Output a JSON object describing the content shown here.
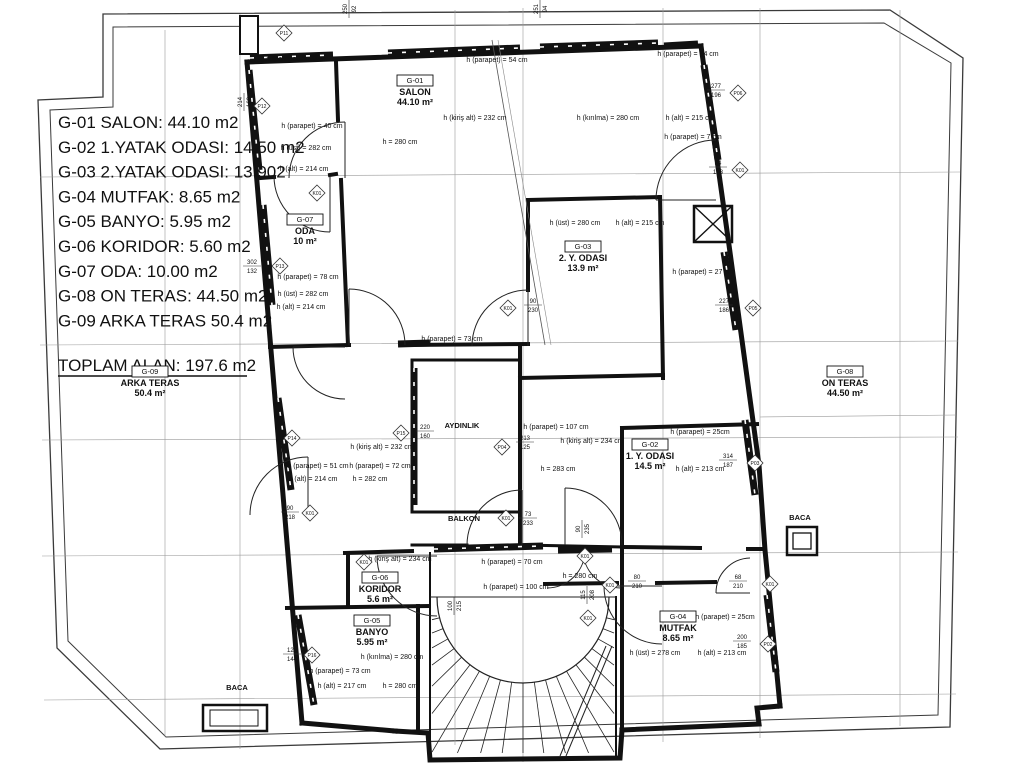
{
  "colors": {
    "line": "#1a1a1a",
    "bg": "#ffffff",
    "grid": "#8a8a8a"
  },
  "legend": {
    "items": [
      "G-01 SALON: 44.10 m2",
      "G-02  1.YATAK ODASI: 14.50 m2",
      "G-03  2.YATAK ODASI: 13.902",
      "G-04  MUTFAK: 8.65 m2",
      "G-05 BANYO: 5.95 m2",
      "G-06 KORIDOR: 5.60 m2",
      "G-07 ODA: 10.00 m2",
      "G-08 ON TERAS: 44.50 m2",
      "G-09 ARKA TERAS 50.4 m2"
    ],
    "total": "TOPLAM ALAN: 197.6 m2"
  },
  "rooms": [
    {
      "code": "G-01",
      "name": "SALON",
      "area": "44.10  m²",
      "x": 415,
      "y": 83
    },
    {
      "code": "G-03",
      "name": "2. Y. ODASI",
      "area": "13.9 m²",
      "x": 583,
      "y": 249
    },
    {
      "code": "G-07",
      "name": "ODA",
      "area": "10 m²",
      "x": 305,
      "y": 222
    },
    {
      "code": "G-02",
      "name": "1. Y. ODASI",
      "area": "14.5 m²",
      "x": 650,
      "y": 447
    },
    {
      "code": "G-06",
      "name": "KORIDOR",
      "area": "5.6 m²",
      "x": 380,
      "y": 580
    },
    {
      "code": "G-05",
      "name": "BANYO",
      "area": "5.95 m²",
      "x": 372,
      "y": 623
    },
    {
      "code": "G-04",
      "name": "MUTFAK",
      "area": "8.65 m²",
      "x": 678,
      "y": 619
    },
    {
      "code": "G-08",
      "name": "ON TERAS",
      "area": "44.50 m²",
      "x": 845,
      "y": 374
    },
    {
      "code": "G-09",
      "name": "ARKA TERAS",
      "area": "50.4 m²",
      "x": 150,
      "y": 374
    },
    {
      "code": null,
      "name": "AYDINLIK",
      "area": "",
      "x": 462,
      "y": 428
    },
    {
      "code": null,
      "name": "BALKON",
      "area": "",
      "x": 464,
      "y": 521
    },
    {
      "code": null,
      "name": "BACA",
      "area": "",
      "x": 237,
      "y": 690
    },
    {
      "code": null,
      "name": "BACA",
      "area": "",
      "x": 800,
      "y": 520
    }
  ],
  "annotations": [
    {
      "text": "h (parapet) = 40 cm",
      "x": 297,
      "y": 61
    },
    {
      "text": "h (parapet) = 54 cm",
      "x": 497,
      "y": 62
    },
    {
      "text": "h (parapet) = 54 cm",
      "x": 688,
      "y": 56
    },
    {
      "text": "h (parapet) = 40 cm",
      "x": 312,
      "y": 128
    },
    {
      "text": "h (üst) = 282 cm",
      "x": 306,
      "y": 150
    },
    {
      "text": "h (alt) = 214 cm",
      "x": 304,
      "y": 171
    },
    {
      "text": "h (kiriş alt) = 232 cm",
      "x": 475,
      "y": 120
    },
    {
      "text": "h = 280 cm",
      "x": 400,
      "y": 144
    },
    {
      "text": "h (kırılma) = 280 cm",
      "x": 608,
      "y": 120
    },
    {
      "text": "h (alt) = 215 cm",
      "x": 690,
      "y": 120
    },
    {
      "text": "h (parapet) = 7 cm",
      "x": 693,
      "y": 139
    },
    {
      "text": "h (üst) = 280 cm",
      "x": 575,
      "y": 225
    },
    {
      "text": "h (alt) = 215 cm",
      "x": 640,
      "y": 225
    },
    {
      "text": "h (parapet) = 27 cm",
      "x": 703,
      "y": 274
    },
    {
      "text": "h (parapet) = 78 cm",
      "x": 308,
      "y": 279
    },
    {
      "text": "h (üst) = 282 cm",
      "x": 303,
      "y": 296
    },
    {
      "text": "h (alt) = 214 cm",
      "x": 301,
      "y": 309
    },
    {
      "text": "h (parapet) = 73 cm",
      "x": 452,
      "y": 341
    },
    {
      "text": "h (parapet) = 51 cm",
      "x": 318,
      "y": 468
    },
    {
      "text": "h (alt) = 214 cm",
      "x": 313,
      "y": 481
    },
    {
      "text": "h (kiriş alt) = 232 cm",
      "x": 382,
      "y": 449
    },
    {
      "text": "h (parapet) = 72 cm",
      "x": 380,
      "y": 468
    },
    {
      "text": "h = 282 cm",
      "x": 370,
      "y": 481
    },
    {
      "text": "h (parapet) = 107 cm",
      "x": 556,
      "y": 429
    },
    {
      "text": "h (kiriş alt) = 234 cm",
      "x": 592,
      "y": 443
    },
    {
      "text": "h = 283 cm",
      "x": 558,
      "y": 471
    },
    {
      "text": "h (parapet) = 25cm",
      "x": 700,
      "y": 434
    },
    {
      "text": "h (alt) = 213 cm",
      "x": 700,
      "y": 471
    },
    {
      "text": "h (kiriş alt) = 234 cm",
      "x": 400,
      "y": 561
    },
    {
      "text": "h (parapet) = 70 cm",
      "x": 512,
      "y": 564
    },
    {
      "text": "h (parapet) = 100 cm",
      "x": 516,
      "y": 589
    },
    {
      "text": "h = 280 cm",
      "x": 580,
      "y": 578
    },
    {
      "text": "h (kırılma) = 280 cm",
      "x": 392,
      "y": 659
    },
    {
      "text": "h (parapet) = 73 cm",
      "x": 340,
      "y": 673
    },
    {
      "text": "h (alt) = 217 cm",
      "x": 342,
      "y": 688
    },
    {
      "text": "h = 280 cm",
      "x": 400,
      "y": 688
    },
    {
      "text": "h (üst) = 278 cm",
      "x": 655,
      "y": 655
    },
    {
      "text": "h (alt) = 213 cm",
      "x": 722,
      "y": 655
    },
    {
      "text": "h (parapet) = 25cm",
      "x": 725,
      "y": 619
    }
  ],
  "markers": [
    {
      "label": "P11",
      "x": 284,
      "y": 33
    },
    {
      "label": "P12",
      "x": 262,
      "y": 106
    },
    {
      "label": "P13",
      "x": 280,
      "y": 266
    },
    {
      "label": "P14",
      "x": 292,
      "y": 438
    },
    {
      "label": "P15",
      "x": 401,
      "y": 433
    },
    {
      "label": "P16",
      "x": 312,
      "y": 655
    },
    {
      "label": "P06",
      "x": 738,
      "y": 93
    },
    {
      "label": "P05",
      "x": 753,
      "y": 308
    },
    {
      "label": "P04",
      "x": 502,
      "y": 447
    },
    {
      "label": "P03",
      "x": 755,
      "y": 463
    },
    {
      "label": "P02",
      "x": 768,
      "y": 644
    },
    {
      "label": "K01",
      "x": 317,
      "y": 193
    },
    {
      "label": "K01",
      "x": 508,
      "y": 308
    },
    {
      "label": "K01",
      "x": 740,
      "y": 170
    },
    {
      "label": "K01",
      "x": 310,
      "y": 513
    },
    {
      "label": "K01",
      "x": 506,
      "y": 518
    },
    {
      "label": "K01",
      "x": 364,
      "y": 562
    },
    {
      "label": "K01",
      "x": 585,
      "y": 556
    },
    {
      "label": "K01",
      "x": 610,
      "y": 585
    },
    {
      "label": "K01",
      "x": 588,
      "y": 618
    },
    {
      "label": "K01",
      "x": 770,
      "y": 584
    }
  ],
  "dims": [
    {
      "a": "214",
      "b": "168",
      "x": 242,
      "y": 102,
      "rot": true
    },
    {
      "a": "302",
      "b": "132",
      "x": 252,
      "y": 264,
      "rot": false
    },
    {
      "a": "90",
      "b": "230",
      "x": 533,
      "y": 303,
      "rot": false
    },
    {
      "a": "277",
      "b": "196",
      "x": 716,
      "y": 88,
      "rot": false
    },
    {
      "a": "227",
      "b": "186",
      "x": 724,
      "y": 303,
      "rot": false
    },
    {
      "a": "220",
      "b": "160",
      "x": 425,
      "y": 429,
      "rot": false
    },
    {
      "a": "213",
      "b": "125",
      "x": 525,
      "y": 440,
      "rot": false
    },
    {
      "a": "314",
      "b": "187",
      "x": 728,
      "y": 458,
      "rot": false
    },
    {
      "a": "90",
      "b": "218",
      "x": 290,
      "y": 510,
      "rot": false
    },
    {
      "a": "73",
      "b": "233",
      "x": 528,
      "y": 516,
      "rot": false
    },
    {
      "a": "90",
      "b": "235",
      "x": 580,
      "y": 529,
      "rot": true
    },
    {
      "a": "125",
      "b": "144",
      "x": 292,
      "y": 652,
      "rot": false
    },
    {
      "a": "80",
      "b": "210",
      "x": 637,
      "y": 579,
      "rot": false
    },
    {
      "a": "68",
      "b": "210",
      "x": 738,
      "y": 579,
      "rot": false
    },
    {
      "a": "200",
      "b": "185",
      "x": 742,
      "y": 639,
      "rot": false
    },
    {
      "a": "84",
      "b": "178",
      "x": 718,
      "y": 165,
      "rot": false
    },
    {
      "a": "100",
      "b": "215",
      "x": 452,
      "y": 606,
      "rot": true
    },
    {
      "a": "115",
      "b": "208",
      "x": 585,
      "y": 595,
      "rot": true
    },
    {
      "a": "250",
      "b": "92",
      "x": 347,
      "y": 9,
      "rot": true
    },
    {
      "a": "251",
      "b": "94",
      "x": 538,
      "y": 9,
      "rot": true
    }
  ]
}
